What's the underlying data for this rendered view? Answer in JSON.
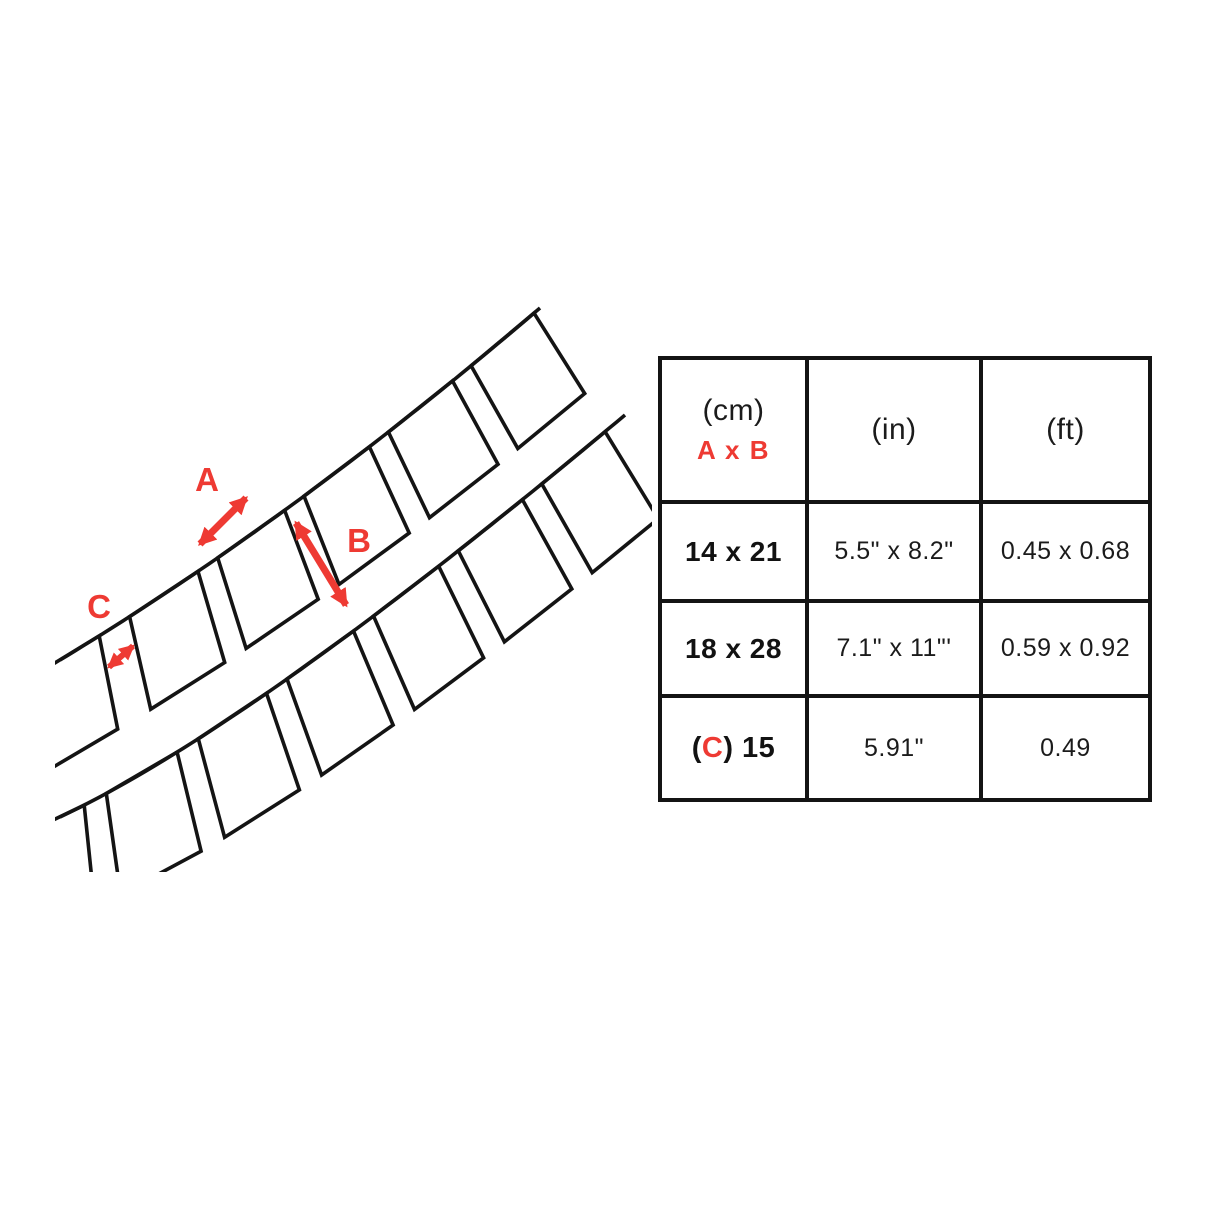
{
  "diagram": {
    "label_a": "A",
    "label_b": "B",
    "label_c": "C",
    "accent_color": "#ee3a33",
    "line_color": "#141414"
  },
  "table": {
    "header": {
      "unit_cm": "(cm)",
      "dims_label": "A x B",
      "unit_in": "(in)",
      "unit_ft": "(ft)"
    },
    "rows": [
      {
        "cm": "14 x 21",
        "inches": "5.5\" x 8.2\"",
        "feet": "0.45 x 0.68"
      },
      {
        "cm": "18 x 28",
        "inches": "7.1\" x 11\"'",
        "feet": "0.59 x 0.92"
      },
      {
        "cm_open": "(",
        "cm_c_label": "C",
        "cm_rest": ") 15",
        "inches": "5.91\"",
        "feet": "0.49"
      }
    ]
  }
}
